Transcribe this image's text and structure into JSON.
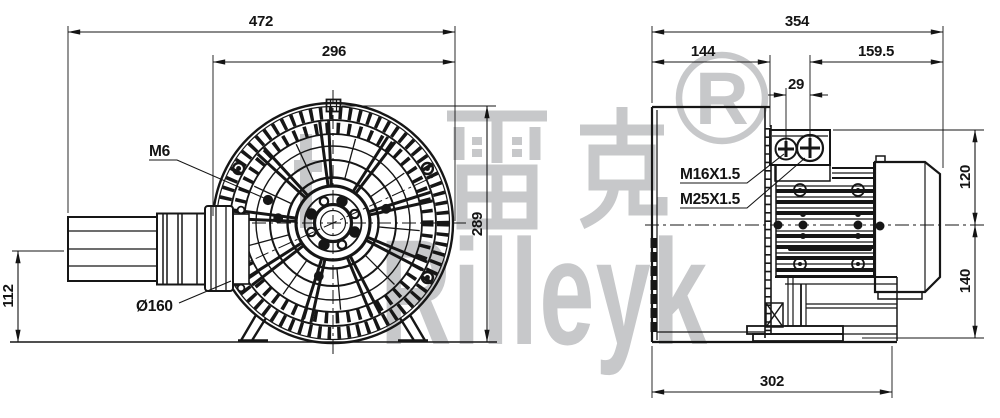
{
  "watermark": {
    "brand_cjk": "雷克",
    "brand_latin": "Rilleyk",
    "registered_r": "R",
    "color": "#c7c8ca"
  },
  "front_view": {
    "dim_overall_width": "472",
    "dim_guard_width": "296",
    "dim_height": "289",
    "dim_inlet_axis_height": "112",
    "label_bolt": "M6",
    "label_inlet_diameter": "Ø160"
  },
  "side_view": {
    "dim_overall_length": "354",
    "dim_housing_length": "144",
    "dim_motor_length": "159.5",
    "dim_gland_spacing": "29",
    "label_gland_small": "M16X1.5",
    "label_gland_large": "M25X1.5",
    "dim_axis_to_top": "120",
    "dim_axis_to_bottom": "140",
    "dim_base_length": "302"
  },
  "colors": {
    "line": "#161616",
    "dimension": "#141414",
    "watermark": "#c7c8ca",
    "background": "#ffffff"
  }
}
